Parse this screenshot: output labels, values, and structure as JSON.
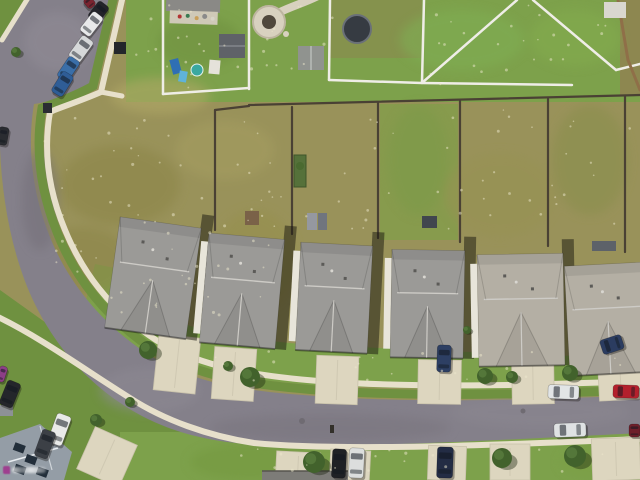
{
  "scene": {
    "title": "Aerial top-down drone photo of a suburban neighborhood: a curving asphalt street with sidewalks, a row of six gray-shingle-roof houses with driveways, long fenced backyards above, green and dormant-olive lawns, and cars parked along the street and driveways",
    "view": "top-down aerial",
    "house_count": 6,
    "notes": "Road enters at top-left with a column of parallel-parked cars, sweeps down and right across the bottom. White vinyl fences enclose upper backyards; dark wood fences divide the long rear yards of the house row. Details include a stone fire-pit circle, a dark round trampoline, sheds, a kiddie pool, AC units, and a slate-roof house in the bottom-left corner."
  },
  "watermark": {
    "present": true,
    "legible": false
  },
  "palette": {
    "field": "#99925a",
    "field2": "#8d8750",
    "grass": "#7da14b",
    "grass2": "#8bae52",
    "grass3": "#6f9140",
    "road": "#84808a",
    "road2": "#77737d",
    "concrete": "#e7e0cb",
    "concrete2": "#ddd6bf",
    "curb": "#d8d2c0",
    "roof_gray": "#9b9a97",
    "roof_light": "#b4afa4",
    "ridge": "#cdcbc6",
    "wall": "#e8e5da",
    "fence_white": "#efede7",
    "fence_dark": "#4a4134",
    "fence_tan": "#8f6f48",
    "tree": "#42622c",
    "tree_dark": "#2e4a1e",
    "wm": "#a0308c"
  },
  "houses": [
    {
      "name": "house-1",
      "x": 112,
      "y": 222,
      "w": 82,
      "h": 112,
      "a": 8,
      "roof": "gray",
      "wall": false
    },
    {
      "name": "house-2",
      "x": 204,
      "y": 236,
      "w": 76,
      "h": 110,
      "a": 5,
      "roof": "gray",
      "wall": true
    },
    {
      "name": "house-3",
      "x": 298,
      "y": 244,
      "w": 72,
      "h": 108,
      "a": 3,
      "roof": "gray",
      "wall": true
    },
    {
      "name": "house-4",
      "x": 391,
      "y": 250,
      "w": 73,
      "h": 108,
      "a": 1,
      "roof": "gray",
      "wall": true
    },
    {
      "name": "house-5",
      "x": 478,
      "y": 254,
      "w": 86,
      "h": 112,
      "a": -1,
      "roof": "light",
      "wall": true
    },
    {
      "name": "house-6",
      "x": 567,
      "y": 264,
      "w": 82,
      "h": 110,
      "a": -3,
      "roof": "light",
      "wall": false
    }
  ],
  "driveways": [
    {
      "name": "driveway-1",
      "x": 156,
      "y": 336,
      "w": 42,
      "h": 56,
      "a": 6
    },
    {
      "name": "driveway-2",
      "x": 213,
      "y": 348,
      "w": 42,
      "h": 52,
      "a": 4
    },
    {
      "name": "driveway-3",
      "x": 316,
      "y": 356,
      "w": 42,
      "h": 48,
      "a": 2
    },
    {
      "name": "driveway-4",
      "x": 418,
      "y": 360,
      "w": 43,
      "h": 44,
      "a": 1
    },
    {
      "name": "driveway-5",
      "x": 512,
      "y": 362,
      "w": 42,
      "h": 42,
      "a": -1
    },
    {
      "name": "driveway-6",
      "x": 598,
      "y": 340,
      "w": 44,
      "h": 60,
      "a": -3
    },
    {
      "name": "driveway-corner",
      "x": 84,
      "y": 434,
      "w": 46,
      "h": 46,
      "a": 24
    },
    {
      "name": "driveway-b2",
      "x": 276,
      "y": 452,
      "w": 44,
      "h": 28,
      "a": 3
    },
    {
      "name": "driveway-b3",
      "x": 330,
      "y": 450,
      "w": 40,
      "h": 30,
      "a": 3
    },
    {
      "name": "driveway-b4",
      "x": 428,
      "y": 446,
      "w": 38,
      "h": 34,
      "a": 2
    },
    {
      "name": "driveway-b5",
      "x": 490,
      "y": 444,
      "w": 40,
      "h": 36,
      "a": 0
    },
    {
      "name": "driveway-b6",
      "x": 592,
      "y": 438,
      "w": 48,
      "h": 42,
      "a": -2
    }
  ],
  "cars": [
    {
      "name": "maroon-car-top",
      "x": 84,
      "y": -2,
      "w": 11,
      "h": 9,
      "a": 50,
      "c": "#7a2430"
    },
    {
      "name": "black-car-top",
      "x": 92,
      "y": 2,
      "w": 13,
      "h": 20,
      "a": 38,
      "c": "#23242a"
    },
    {
      "name": "white-car-top",
      "x": 85,
      "y": 12,
      "w": 13,
      "h": 24,
      "a": 38,
      "c": "#e8e9ea"
    },
    {
      "name": "silver-van-top",
      "x": 74,
      "y": 36,
      "w": 14,
      "h": 26,
      "a": 36,
      "c": "#d6d8d9"
    },
    {
      "name": "blue-car-1",
      "x": 62,
      "y": 57,
      "w": 13,
      "h": 24,
      "a": 34,
      "c": "#3a6ea8"
    },
    {
      "name": "blue-car-2",
      "x": 56,
      "y": 72,
      "w": 13,
      "h": 24,
      "a": 32,
      "c": "#2f5d96"
    },
    {
      "name": "dark-car-left-edge",
      "x": -2,
      "y": 127,
      "w": 10,
      "h": 18,
      "a": 10,
      "c": "#2a2c31"
    },
    {
      "name": "magenta-car-left",
      "x": -2,
      "y": 366,
      "w": 8,
      "h": 16,
      "a": 18,
      "c": "#8c3f86"
    },
    {
      "name": "black-suv-left",
      "x": 3,
      "y": 381,
      "w": 14,
      "h": 26,
      "a": 22,
      "c": "#24262b"
    },
    {
      "name": "white-pickup-corner",
      "x": 52,
      "y": 414,
      "w": 15,
      "h": 31,
      "a": 20,
      "c": "#e9eae8"
    },
    {
      "name": "gray-suv-corner",
      "x": 38,
      "y": 430,
      "w": 14,
      "h": 28,
      "a": 20,
      "c": "#3c4046"
    },
    {
      "name": "navy-car-driveway-4",
      "x": 437,
      "y": 345,
      "w": 14,
      "h": 27,
      "a": 2,
      "c": "#2d3f63"
    },
    {
      "name": "navy-car-driveway-6",
      "x": 601,
      "y": 337,
      "w": 22,
      "h": 15,
      "a": -18,
      "c": "#2b3c60"
    },
    {
      "name": "white-car-street-north",
      "x": 548,
      "y": 385,
      "w": 31,
      "h": 14,
      "a": 2,
      "c": "#e2e5e6"
    },
    {
      "name": "red-car-street",
      "x": 613,
      "y": 385,
      "w": 26,
      "h": 13,
      "a": 2,
      "c": "#b3202c"
    },
    {
      "name": "white-car-street-south",
      "x": 554,
      "y": 423,
      "w": 32,
      "h": 14,
      "a": -2,
      "c": "#dfe2e3"
    },
    {
      "name": "maroon-car-right-edge",
      "x": 629,
      "y": 424,
      "w": 11,
      "h": 13,
      "a": 0,
      "c": "#6e1f2a"
    },
    {
      "name": "black-suv-bottom",
      "x": 332,
      "y": 449,
      "w": 14,
      "h": 29,
      "a": 3,
      "c": "#1f2125"
    },
    {
      "name": "white-suv-bottom",
      "x": 349,
      "y": 448,
      "w": 15,
      "h": 30,
      "a": 3,
      "c": "#dcdedd"
    },
    {
      "name": "navy-van-bottom",
      "x": 437,
      "y": 447,
      "w": 16,
      "h": 31,
      "a": 2,
      "c": "#232c44"
    }
  ],
  "trees": [
    {
      "x": 148,
      "y": 350,
      "r": 9
    },
    {
      "x": 250,
      "y": 377,
      "r": 10
    },
    {
      "x": 228,
      "y": 366,
      "r": 5
    },
    {
      "x": 485,
      "y": 376,
      "r": 8
    },
    {
      "x": 570,
      "y": 373,
      "r": 8
    },
    {
      "x": 512,
      "y": 377,
      "r": 6
    },
    {
      "x": 314,
      "y": 462,
      "r": 11
    },
    {
      "x": 502,
      "y": 458,
      "r": 10
    },
    {
      "x": 575,
      "y": 456,
      "r": 11
    },
    {
      "x": 96,
      "y": 420,
      "r": 6
    },
    {
      "x": 130,
      "y": 402,
      "r": 5
    },
    {
      "x": 16,
      "y": 52,
      "r": 5
    },
    {
      "x": 467,
      "y": 330,
      "r": 4
    }
  ],
  "fences": [
    {
      "x1": 163,
      "y1": 0,
      "x2": 163,
      "y2": 94,
      "t": "w"
    },
    {
      "x1": 163,
      "y1": 94,
      "x2": 249,
      "y2": 88,
      "t": "w"
    },
    {
      "x1": 249,
      "y1": 0,
      "x2": 249,
      "y2": 89,
      "t": "w"
    },
    {
      "x1": 330,
      "y1": 0,
      "x2": 329,
      "y2": 80,
      "t": "w"
    },
    {
      "x1": 424,
      "y1": 0,
      "x2": 422,
      "y2": 82,
      "t": "w"
    },
    {
      "x1": 517,
      "y1": 0,
      "x2": 423,
      "y2": 82,
      "t": "w"
    },
    {
      "x1": 533,
      "y1": 0,
      "x2": 616,
      "y2": 70,
      "t": "w"
    },
    {
      "x1": 329,
      "y1": 80,
      "x2": 422,
      "y2": 83,
      "t": "w"
    },
    {
      "x1": 422,
      "y1": 83,
      "x2": 572,
      "y2": 85,
      "t": "w"
    },
    {
      "x1": 616,
      "y1": 70,
      "x2": 640,
      "y2": 64,
      "t": "w"
    },
    {
      "x1": 249,
      "y1": 105,
      "x2": 640,
      "y2": 95,
      "t": "d"
    },
    {
      "x1": 215,
      "y1": 110,
      "x2": 249,
      "y2": 106,
      "t": "d"
    },
    {
      "x1": 215,
      "y1": 110,
      "x2": 215,
      "y2": 230,
      "t": "d"
    },
    {
      "x1": 292,
      "y1": 107,
      "x2": 292,
      "y2": 234,
      "t": "d"
    },
    {
      "x1": 378,
      "y1": 103,
      "x2": 378,
      "y2": 238,
      "t": "d"
    },
    {
      "x1": 460,
      "y1": 101,
      "x2": 460,
      "y2": 242,
      "t": "d"
    },
    {
      "x1": 548,
      "y1": 99,
      "x2": 548,
      "y2": 246,
      "t": "d"
    },
    {
      "x1": 625,
      "y1": 96,
      "x2": 625,
      "y2": 252,
      "t": "d"
    },
    {
      "x1": 618,
      "y1": 0,
      "x2": 628,
      "y2": 60,
      "t": "t"
    },
    {
      "x1": 628,
      "y1": 60,
      "x2": 640,
      "y2": 90,
      "t": "t"
    }
  ],
  "speckle_regions": [
    {
      "x": 45,
      "y": 115,
      "w": 240,
      "h": 200,
      "n": 70
    },
    {
      "x": 300,
      "y": 110,
      "w": 330,
      "h": 120,
      "n": 40
    },
    {
      "x": 135,
      "y": 5,
      "w": 200,
      "h": 85,
      "n": 30
    },
    {
      "x": 430,
      "y": 5,
      "w": 180,
      "h": 80,
      "n": 25
    },
    {
      "x": 200,
      "y": 350,
      "w": 430,
      "h": 32,
      "n": 22
    },
    {
      "x": 240,
      "y": 448,
      "w": 390,
      "h": 28,
      "n": 18
    }
  ]
}
